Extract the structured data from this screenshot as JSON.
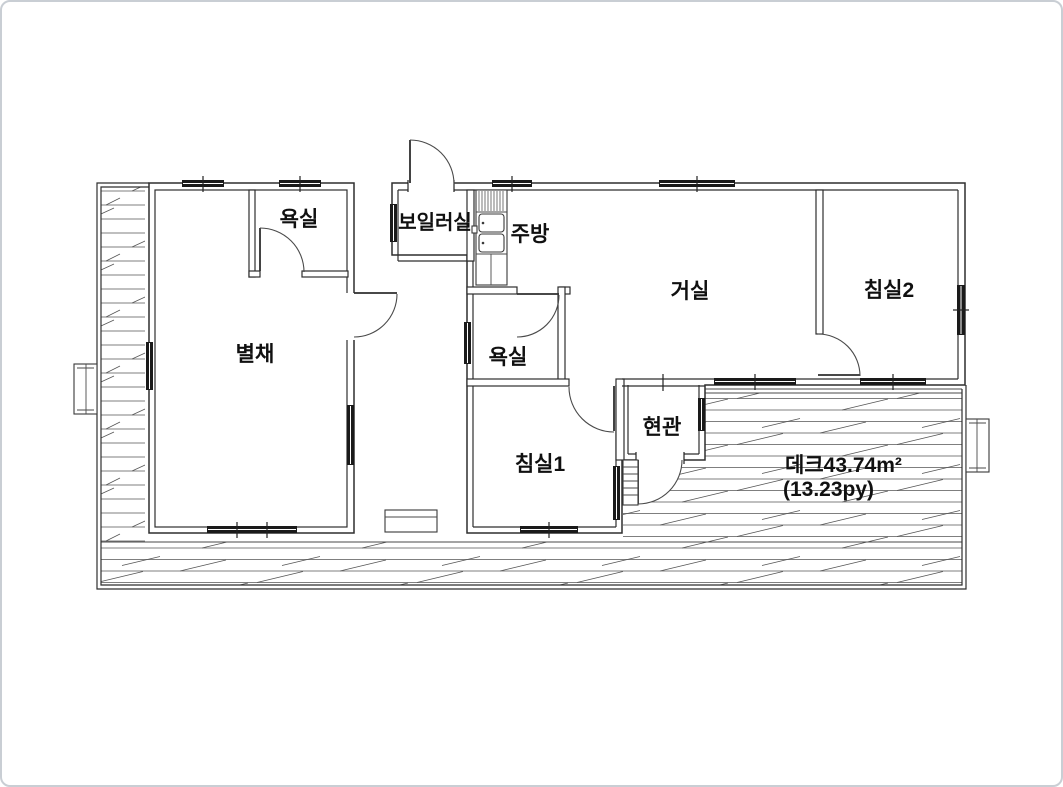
{
  "type": "floor-plan",
  "rooms": [
    {
      "id": "annex-bathroom",
      "label": "욕실"
    },
    {
      "id": "boiler-room",
      "label": "보일러실"
    },
    {
      "id": "kitchen",
      "label": "주방"
    },
    {
      "id": "living-room",
      "label": "거실"
    },
    {
      "id": "bedroom2",
      "label": "침실2"
    },
    {
      "id": "annex",
      "label": "별채"
    },
    {
      "id": "bathroom",
      "label": "욕실"
    },
    {
      "id": "entrance",
      "label": "현관"
    },
    {
      "id": "bedroom1",
      "label": "침실1"
    }
  ],
  "deck": {
    "area_label": "데크43.74m²",
    "py_label": "(13.23py)"
  },
  "colors": {
    "line": "#2e2e2e",
    "window_fill": "#1a1a1a",
    "background": "#ffffff"
  }
}
